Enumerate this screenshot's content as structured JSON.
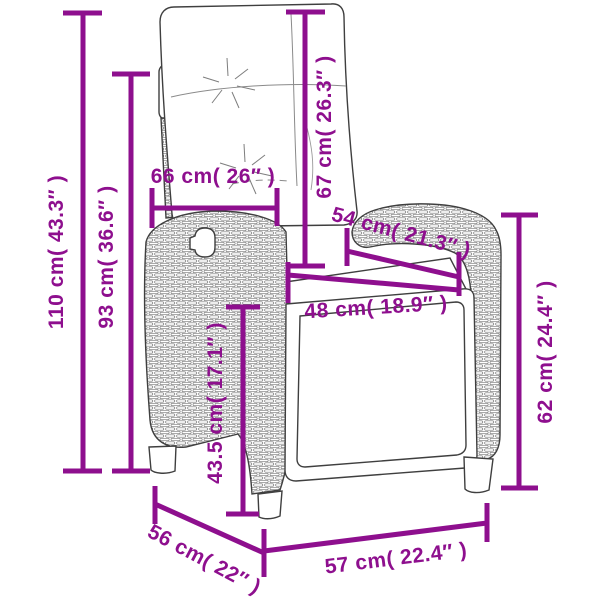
{
  "page": {
    "background": "#ffffff",
    "accent_color": "#8E0F8E",
    "line_color": "#3f3f3f",
    "unit_system": "cm ( inches )"
  },
  "diagram": {
    "subject": "reclining rattan garden chair with back cushion, line drawing with dimension arrows",
    "dimensions": {
      "d110": "110 cm( 43.3″ )",
      "d93": "93 cm( 36.6″ )",
      "d66": "66 cm( 26″ )",
      "d67": "67 cm( 26.3″ )",
      "d54": "54 cm( 21.3″ )",
      "d48": "48 cm( 18.9″ )",
      "d62": "62 cm( 24.4″ )",
      "d435": "43.5 cm( 17.1″ )",
      "d56": "56 cm( 22″ )",
      "d57": "57 cm( 22.4″ )"
    }
  }
}
